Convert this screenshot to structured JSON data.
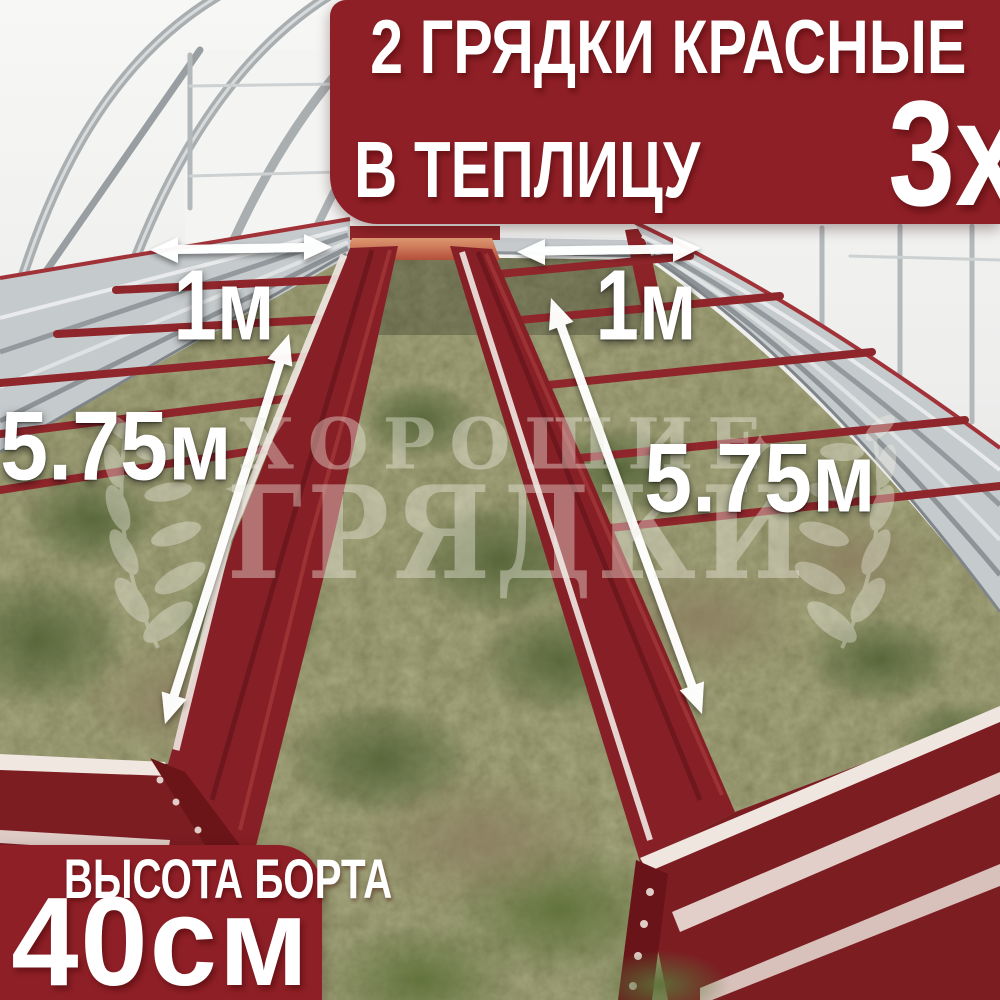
{
  "theme": {
    "banner-red": "#8e1f26",
    "text-white": "#ffffff",
    "bed-red": "#8a2127",
    "rail-orange": "#c97a55",
    "galvanized-silver": "#c5cacc",
    "watermark-color": "#efeee4"
  },
  "header_banner": {
    "line1": "2 ГРЯДКИ КРАСНЫЕ",
    "line2_prefix": "В ТЕПЛИЦУ",
    "line2_value": "3х6м"
  },
  "footer_banner": {
    "title": "ВЫСОТА БОРТА",
    "value": "40см"
  },
  "measurements": {
    "bed_width_left": "1м",
    "bed_width_right": "1м",
    "bed_length_left": "5.75м",
    "bed_length_right": "5.75м"
  },
  "watermark": {
    "line1": "ХОРОШИЕ",
    "line2": "ГРЯДКИ"
  }
}
